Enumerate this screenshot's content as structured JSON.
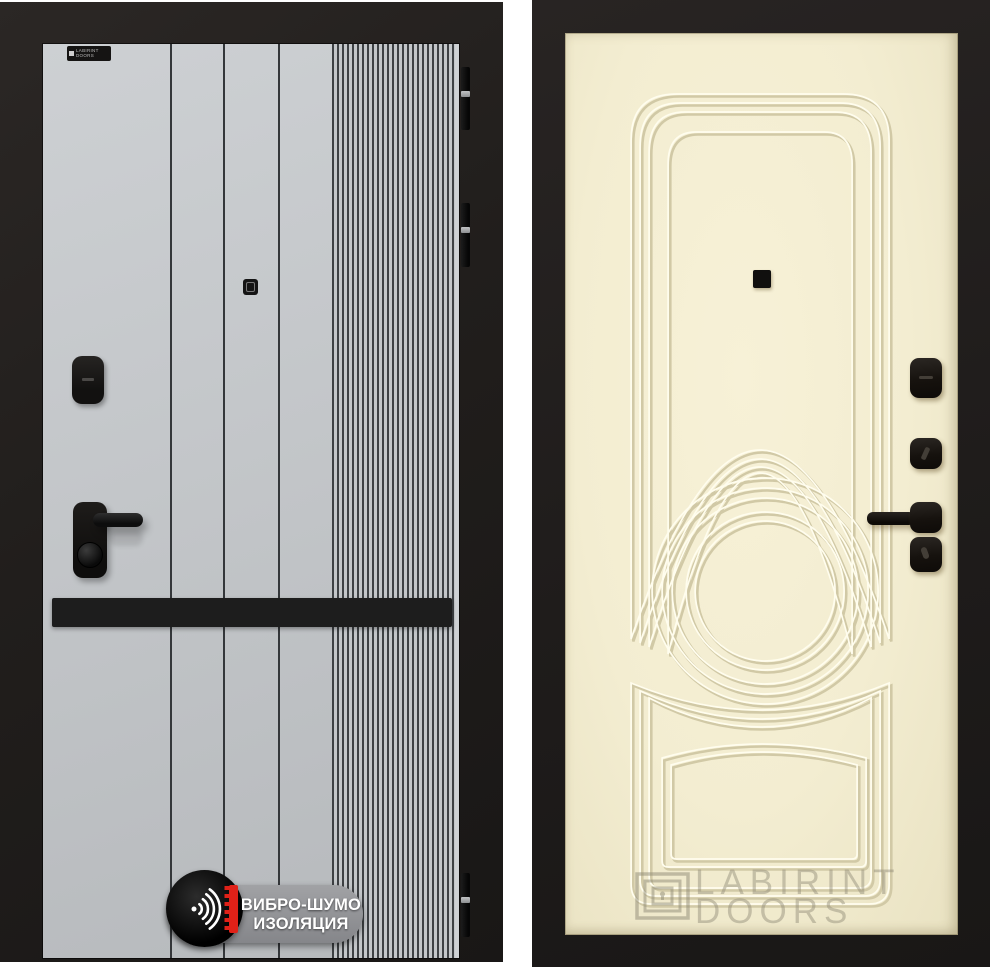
{
  "left_door": {
    "description": "grey modern door leaf with vertical grooves, ribbed strip, black kick band and black hardware",
    "brand_label": "LABIRINT DOORS",
    "insulation_badge": {
      "line1": "ВИБРО-ШУМО",
      "line2": "ИЗОЛЯЦИЯ",
      "icon": "sound-wave-icon"
    }
  },
  "right_door": {
    "description": "cream classic molded door leaf with arched panels, center circle molding and black hardware",
    "watermark": {
      "line1": "LABIRINT",
      "line2": "DOORS",
      "icon": "labyrinth-logo-icon"
    }
  },
  "colors": {
    "band": "#1d1d1d",
    "right-leaf": "#f3edd1",
    "mold-shadow": "#d1c9a6",
    "mold-light": "#fffdee",
    "badge-pill": "#85868a",
    "badge-red": "#e02118",
    "badge-text": "#ffffff",
    "watermark": "#8f8a76",
    "hinge-pin": "#8e9092",
    "left-leaf": "#c3c6c9",
    "frame": "#211e1c",
    "hardware": "#17130f"
  }
}
